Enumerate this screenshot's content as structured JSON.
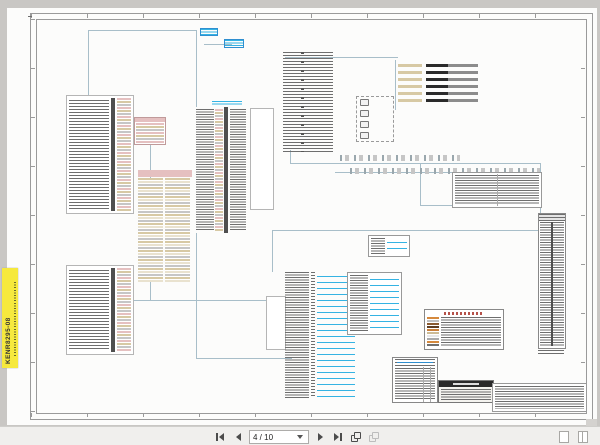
{
  "viewer": {
    "toolbar": {
      "page_field_value": "4 / 10",
      "icons": {
        "first_page": "first-page-icon",
        "previous_page": "previous-page-icon",
        "page_selector": "page-dropdown-caret",
        "next_page": "next-page-icon",
        "last_page": "last-page-icon",
        "previous_view": "previous-view-icon",
        "next_view": "next-view-icon",
        "single_page_view": "single-page-view-icon",
        "two_page_view": "two-page-view-icon"
      }
    }
  },
  "document": {
    "edge_tab_label": "KENR8295-08"
  },
  "colors": {
    "canvas": "#c9c7c4",
    "page": "#fcfcfb",
    "frame": "#9a9a9a",
    "wire": "#a8bec9",
    "cyan": "#35b3e3",
    "blue": "#2f8fd0",
    "tan": "#d7c9a4",
    "pink": "#e5c0c0",
    "red": "#b5524a",
    "grayrow": "#c6c6c6",
    "bar": "#4f4f4f",
    "ink": "#6e6e6e",
    "yellow": "#f6e93d",
    "tbbg": "#f0efed",
    "tbborder": "#cfcecb",
    "icon": "#4c4c4c",
    "icondis": "#bdbdbd",
    "black": "#2a2a2a"
  },
  "schematic": {
    "wire_color_code_chips": [
      "#d5893d",
      "#bfbfbf",
      "#8a5a30",
      "#5e3c20",
      "#c97f39",
      "#cdbb95",
      "#e8e8e8",
      "#a9a9a9",
      "#d5893d",
      "#707070"
    ]
  }
}
